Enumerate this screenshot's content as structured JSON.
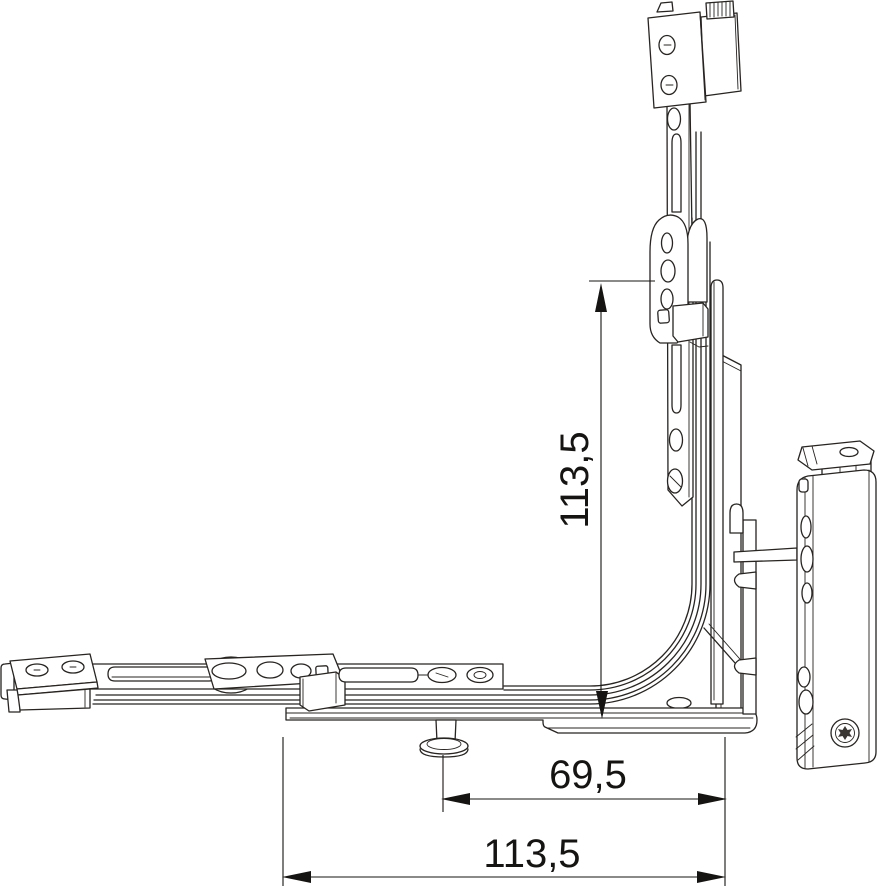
{
  "drawing": {
    "type": "technical-line-drawing",
    "subject": "window corner hinge assembly",
    "background_color": "#ffffff",
    "line_color": "#272421",
    "dimension_color": "#161412",
    "dim_arrow_icon": "filled-triangle"
  },
  "dimensions": {
    "vertical": {
      "label": "113,5",
      "orientation": "vertical"
    },
    "horizontal_inner": {
      "label": "69,5",
      "orientation": "horizontal"
    },
    "horizontal_outer": {
      "label": "113,5",
      "orientation": "horizontal"
    }
  }
}
